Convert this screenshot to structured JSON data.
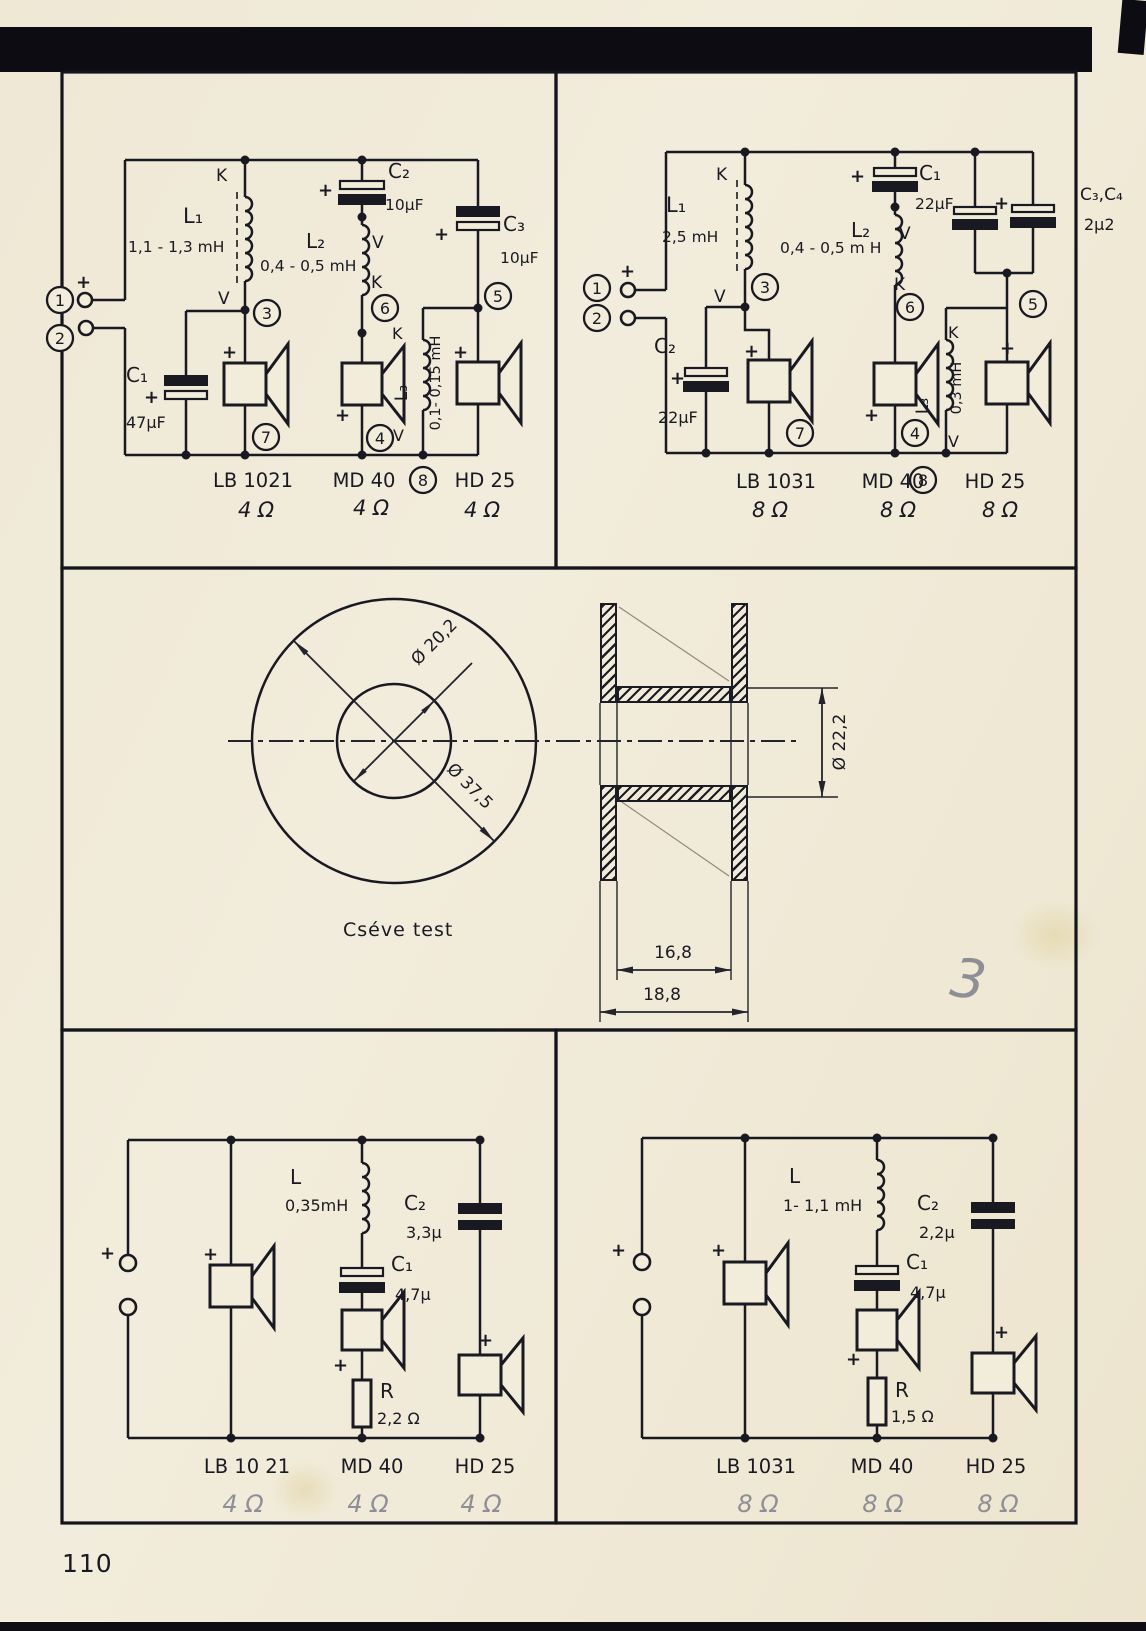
{
  "sym": {
    "plus": "+",
    "K": "K",
    "V": "V"
  },
  "badges": {
    "n1": "1",
    "n2": "2",
    "n3": "3",
    "n4": "4",
    "n5": "5",
    "n6": "6",
    "n7": "7",
    "n8": "8"
  },
  "speakers": {
    "lb4": "LB 1021",
    "lb4b": "LB 10 21",
    "lb8": "LB 1031",
    "md": "MD 40",
    "hd": "HD 25"
  },
  "impedance": {
    "ohm4": "4 Ω",
    "ohm8": "8 Ω"
  },
  "panel_tl": {
    "l1": "L₁",
    "l1_val": "1,1 - 1,3 mH",
    "l2": "L₂",
    "l2_val": "0,4 - 0,5 mH",
    "l3": "L₃",
    "l3_val": "0,1- 0,15 mH",
    "c1": "C₁",
    "c1_val": "47µF",
    "c2": "C₂",
    "c2_val": "10µF",
    "c3": "C₃",
    "c3_val": "10µF"
  },
  "panel_tr": {
    "l1": "L₁",
    "l1_val": "2,5 mH",
    "l2": "L₂",
    "l2_val": "0,4 - 0,5 m H",
    "l3": "L₃",
    "l3_val": "0,3 mH",
    "c1": "C₁",
    "c1_val": "22µF",
    "c2": "C₂",
    "c2_val": "22µF",
    "c34": "C₃,C₄",
    "c34_val": "2µ2"
  },
  "bobbin": {
    "caption": "Cséve test",
    "dia_inner": "Ø 20,2",
    "dia_outer": "Ø 37,5",
    "dia_core": "Ø 22,2",
    "w_inner": "16,8",
    "w_outer": "18,8",
    "pencil_note": "3"
  },
  "panel_bl": {
    "l": "L",
    "l_val": "0,35mH",
    "c1": "C₁",
    "c1_val": "4,7µ",
    "c2": "C₂",
    "c2_val": "3,3µ",
    "r": "R",
    "r_val": "2,2 Ω"
  },
  "panel_br": {
    "l": "L",
    "l_val": "1- 1,1 mH",
    "c1": "C₁",
    "c1_val": "4,7µ",
    "c2": "C₂",
    "c2_val": "2,2µ",
    "r": "R",
    "r_val": "1,5 Ω"
  },
  "page": {
    "number": "110"
  }
}
